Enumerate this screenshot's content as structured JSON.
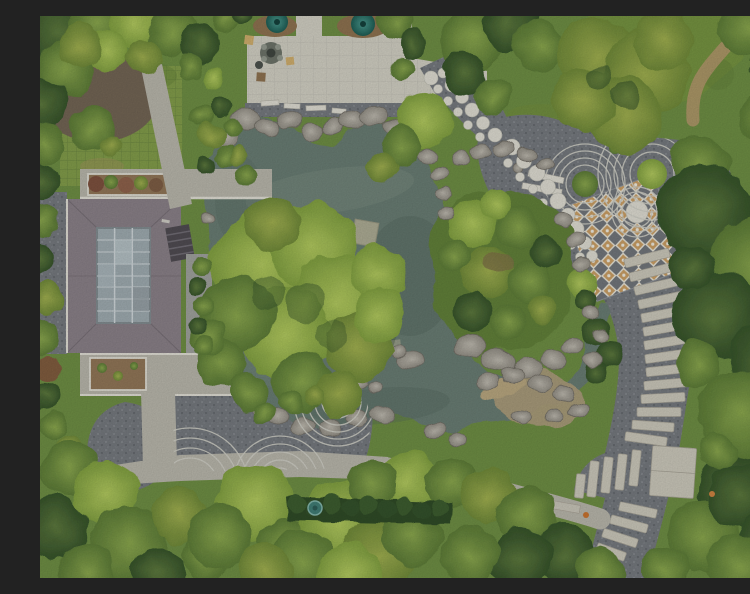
{
  "meta": {
    "type": "aerial-drone-photograph",
    "alt": "Top-down aerial view of a Chinese-style garden: an irregular grey-green pond edged with rockery, a flat-roofed pavilion with a gridded glass skylight, a paver plaza with two conifers and a rock fountain, raked-gravel arc patterns, a curving dark gravel path set with round white stepping stones, a diamond-mosaic terrace, a descending stone-plank walk, and dense surrounding trees."
  },
  "regions": [
    "surrounding-trees",
    "grass-paver-lawn",
    "entrance-plaza",
    "conifer-planters",
    "rock-fountain",
    "pavilion-glass-roof",
    "pond",
    "rockery-shoreline",
    "overhanging-tree",
    "island-shrubs",
    "stepping-dot-path",
    "raked-gravel-arcs",
    "diamond-mosaic-terrace",
    "stone-plank-walk",
    "zen-gravel-garden",
    "stone-benches",
    "garden-paths",
    "clipped-hedge"
  ],
  "palette": {
    "grass_base": "#6b8a42",
    "grass": "#7e9848",
    "grass_shade": "#5d7836",
    "water": "#66796f",
    "water_deep": "#51635a",
    "water_light": "#7d9082",
    "rock": "#a5a198",
    "gravel": "#72767b",
    "rake_line": "#c9c9c0",
    "stone_white": "#d8d6cc",
    "paver": "#cbc9bd",
    "paver_line": "#bcbab0",
    "path": "#b3b1a6",
    "plank": "#c5c2b5",
    "mosaic_tan": "#c49a62",
    "roof": "#867d84",
    "skylight": "#9aa6ab",
    "skylight_frame": "#c9d0d3",
    "soil": "#8d7355",
    "mulch": "#6f6252",
    "dirt": "#ad9468",
    "canopy_bright": "#a8c155",
    "canopy_mid": "#7f9c46",
    "canopy_dark": "#42602f",
    "hedge": "#33502a",
    "teal_tree": "#2c6e68",
    "accent_orange": "#c2702e",
    "sand": "#a59877"
  }
}
